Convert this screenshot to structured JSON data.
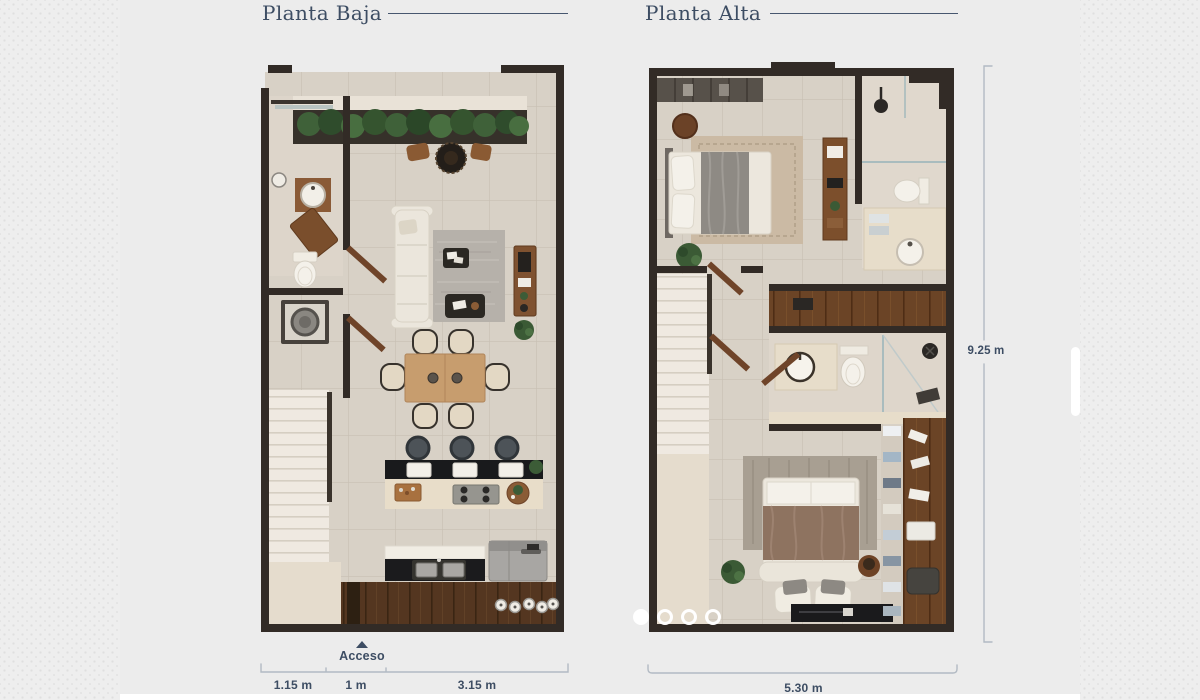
{
  "window": {
    "width": 1200,
    "height": 700
  },
  "theme": {
    "background": "#ececec",
    "dot_pattern_color": "#dfdfdf",
    "accent": "#3d4d63",
    "bracket_color": "#b2bac3",
    "wall_color": "#322b26"
  },
  "plans": {
    "left": {
      "title": "Planta Baja",
      "access_label": "Acceso",
      "width_segments": [
        {
          "label": "1.15 m"
        },
        {
          "label": "1 m"
        },
        {
          "label": "3.15 m"
        }
      ]
    },
    "right": {
      "title": "Planta Alta",
      "width_label": "5.30 m",
      "height_label": "9.25 m"
    }
  },
  "carousel": {
    "dot_count": 4,
    "active_index": 0
  }
}
